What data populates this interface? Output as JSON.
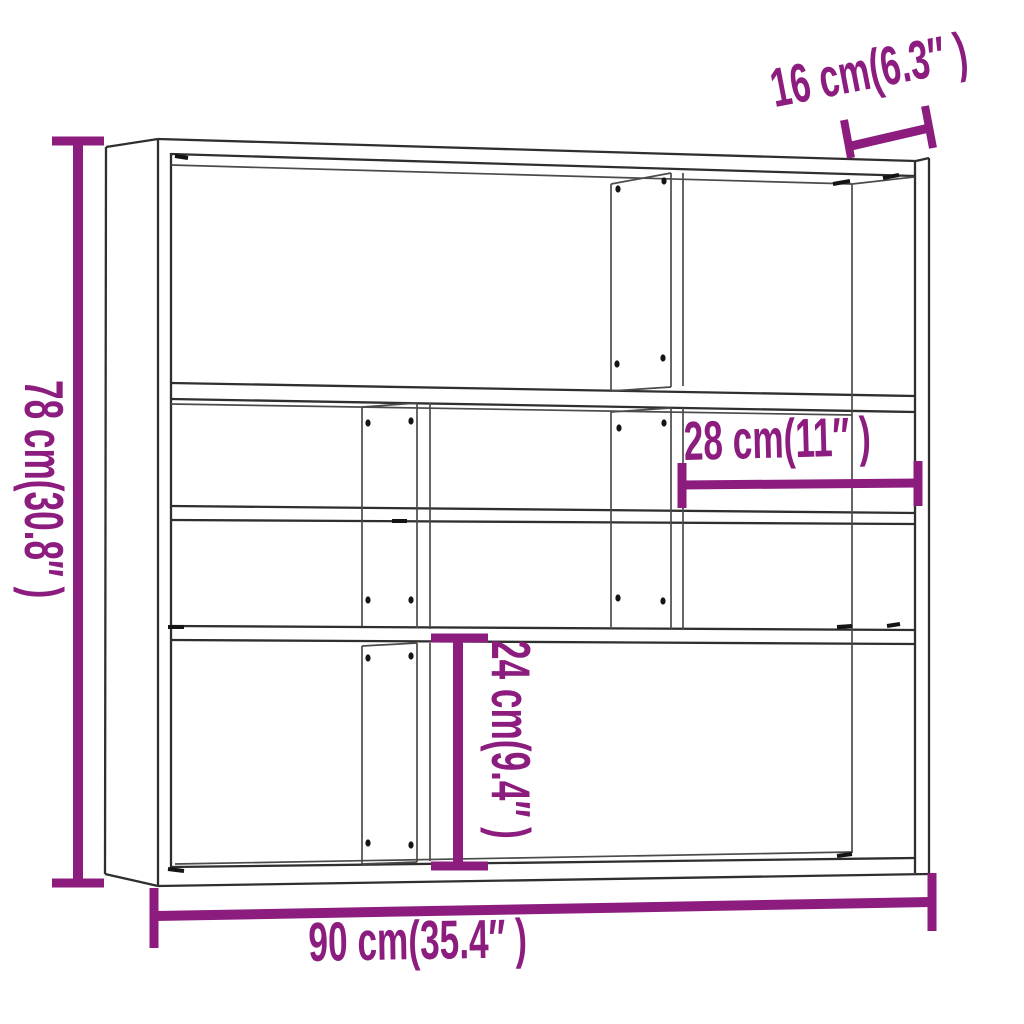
{
  "diagram": {
    "kind": "product-dimension-diagram",
    "subject": "wall-mounted shelf unit with open compartments",
    "background_color": "#ffffff",
    "line_color": "#2f2f2f",
    "dimension_color": "#8C1D7F",
    "dimensions": {
      "height": {
        "label": "78 cm(30.8″ )",
        "value_cm": 78,
        "value_in": 30.8,
        "measures": "overall height",
        "orientation": "vertical-left"
      },
      "depth": {
        "label": "16 cm(6.3″ )",
        "value_cm": 16,
        "value_in": 6.3,
        "measures": "overall depth",
        "orientation": "tilted-top-right"
      },
      "compartment_width": {
        "label": "28 cm(11″ )",
        "value_cm": 28,
        "value_in": 11,
        "measures": "compartment width",
        "orientation": "horizontal-middle-right"
      },
      "compartment_height": {
        "label": "24 cm(9.4″ )",
        "value_cm": 24,
        "value_in": 9.4,
        "measures": "compartment height",
        "orientation": "vertical-middle"
      },
      "width": {
        "label": "90 cm(35.4″ )",
        "value_cm": 90,
        "value_in": 35.4,
        "measures": "overall width",
        "orientation": "horizontal-bottom"
      }
    }
  }
}
